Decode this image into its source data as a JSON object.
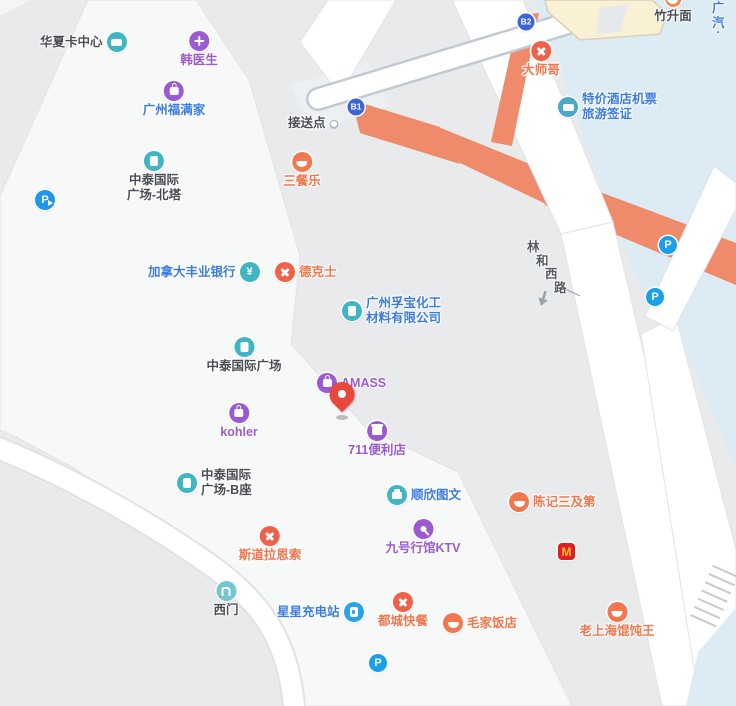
{
  "map": {
    "palette": {
      "base_gray": "#e9eaeb",
      "building_light": "#f7f8f8",
      "plaza_blue": "#dcebf4",
      "overpass_orange": "#ef8a6b",
      "road_white": "#ffffff",
      "walkway_border": "#c3c9d3",
      "building_cream": "#faf0d3",
      "poi_text_dark": "#4a4e54",
      "poi_text_blue": "#3c7ce0",
      "poi_text_purple": "#9b59d2",
      "poi_text_orange": "#f0764e",
      "pin_red": "#e8473c"
    },
    "pois": [
      {
        "name": "华夏卡中心",
        "icon": "card",
        "color": "dark"
      },
      {
        "name": "韩医生",
        "icon": "medical",
        "color": "purple"
      },
      {
        "name": "广州福满家",
        "icon": "bag",
        "color": "blue"
      },
      {
        "name": "中泰国际广场-北塔",
        "lines": [
          "中泰国际",
          "广场-北塔"
        ],
        "icon": "building",
        "color": "dark"
      },
      {
        "name": "加拿大丰业银行",
        "icon": "yen",
        "color": "blue",
        "icon_text": "¥"
      },
      {
        "name": "德克士",
        "icon": "utensils",
        "color": "orange"
      },
      {
        "name": "广州孚宝化工材料有限公司",
        "lines": [
          "广州孚宝化工",
          "材料有限公司"
        ],
        "icon": "building",
        "color": "blue"
      },
      {
        "name": "中泰国际广场",
        "icon": "building",
        "color": "dark"
      },
      {
        "name": "AMASS",
        "icon": "bag",
        "color": "purple"
      },
      {
        "name": "kohler",
        "icon": "bag",
        "color": "purple"
      },
      {
        "name": "711便利店",
        "icon": "store",
        "color": "purple"
      },
      {
        "name": "中泰国际广场-B座",
        "lines": [
          "中泰国际",
          "广场-B座"
        ],
        "icon": "building",
        "color": "dark"
      },
      {
        "name": "顺欣图文",
        "icon": "printer",
        "color": "blue"
      },
      {
        "name": "陈记三及第",
        "icon": "bowl",
        "color": "orange"
      },
      {
        "name": "斯道拉恩索",
        "icon": "utensils",
        "color": "orange"
      },
      {
        "name": "九号行馆KTV",
        "icon": "microphone",
        "color": "purple"
      },
      {
        "name": "西门",
        "icon": "gate",
        "color": "dark"
      },
      {
        "name": "星星充电站",
        "icon": "charger",
        "color": "blue"
      },
      {
        "name": "都城快餐",
        "icon": "utensils",
        "color": "orange"
      },
      {
        "name": "毛家饭店",
        "icon": "bowl",
        "color": "orange"
      },
      {
        "name": "老上海馄饨王",
        "icon": "bowl",
        "color": "orange"
      },
      {
        "name": "三餐乐",
        "icon": "bowl",
        "color": "orange"
      },
      {
        "name": "大师哥",
        "icon": "utensils",
        "color": "orange"
      },
      {
        "name": "接送点",
        "icon": "pickup-dot",
        "color": "dark"
      },
      {
        "name": "特价酒店机票旅游签证",
        "lines": [
          "特价酒店机票",
          "旅游签证"
        ],
        "icon": "ticket",
        "color": "blue"
      },
      {
        "name": "竹升面",
        "icon": "bowl",
        "color": "dark"
      },
      {
        "name": "广汽自动",
        "lines": [
          "广汽",
          "自动"
        ],
        "color": "blue"
      },
      {
        "name": "麦当劳",
        "icon": "mcdonalds",
        "icon_text": "M"
      }
    ],
    "road_label": {
      "name": "林和西路",
      "chars": [
        "林",
        "和",
        "西",
        "路"
      ]
    },
    "transit_badges": [
      {
        "label": "B1"
      },
      {
        "label": "B2"
      }
    ],
    "parking": {
      "label": "P",
      "entrance_label": "P"
    }
  }
}
